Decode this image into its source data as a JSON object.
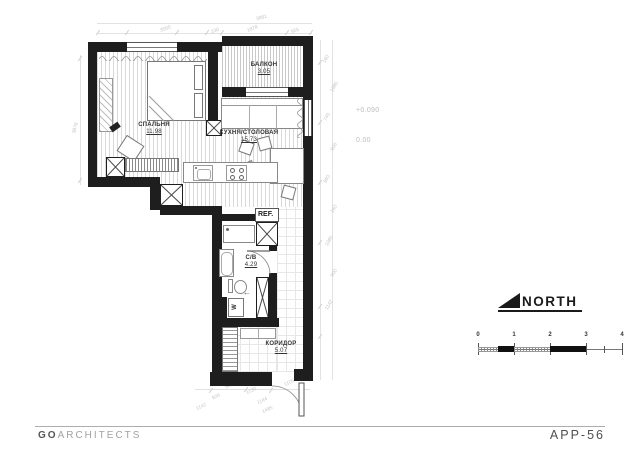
{
  "title_block": {
    "brand_bold": "GO",
    "brand_light": "ARCHITECTS",
    "sheet_code": "APP-56"
  },
  "north_label": "NORTH",
  "levels": {
    "floor": "+0.090",
    "entry": "0.00"
  },
  "rooms": {
    "bedroom": {
      "name": "СПАЛЬНЯ",
      "area": "11.98"
    },
    "balcony": {
      "name": "БАЛКОН",
      "area": "3.05"
    },
    "kitchen": {
      "name": "КУХНЯ/СТОЛОВАЯ",
      "area": "15.73"
    },
    "bathroom": {
      "name": "С/В",
      "area": "4.29"
    },
    "corridor": {
      "name": "КОРИДОР",
      "area": "5.07"
    }
  },
  "appliances": {
    "fridge": "REF.",
    "washer": "W"
  },
  "icons": {
    "toilet_arrow": "←"
  },
  "scalebar": {
    "ticks": [
      "0",
      "1",
      "2",
      "3",
      "4"
    ]
  },
  "dimensions": {
    "top_total": "3881",
    "top": [
      "3000",
      "230",
      "1878",
      "955"
    ],
    "left": [
      "3878"
    ],
    "right": [
      "160",
      "1985",
      "745",
      "906",
      "893",
      "160",
      "1985",
      "900",
      "1142"
    ],
    "bottom": [
      "1142",
      "920",
      "540",
      "1130",
      "1144",
      "1105",
      "1485"
    ]
  }
}
